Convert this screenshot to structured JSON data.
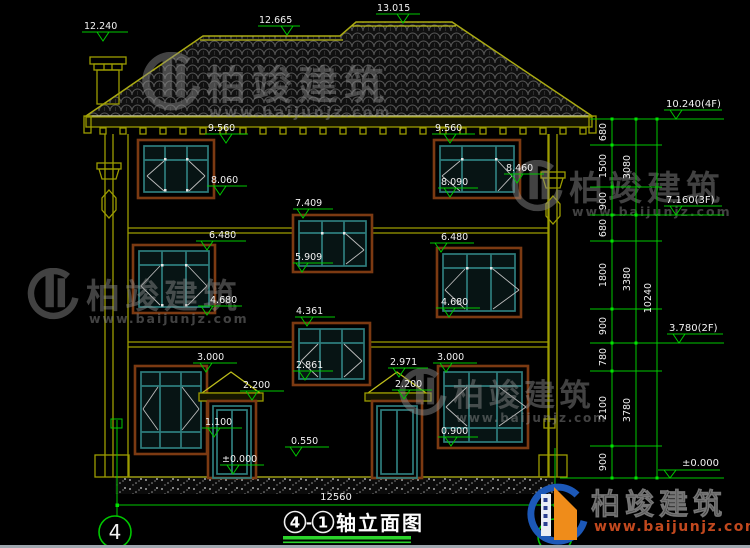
{
  "watermark": {
    "brand": "柏竣建筑",
    "url": "www.baijunjz.com"
  },
  "logo": {
    "brand": "柏竣建筑",
    "url": "www.baijunjz.com"
  },
  "title": {
    "full": "④-①轴立面图",
    "bubble_from": "4",
    "dash": "-",
    "bubble_to": "1",
    "name": "轴立面图",
    "grid_bubble_left": "4"
  },
  "dims": {
    "overall_width": "12560",
    "overall_height": "10240",
    "floor_totals": [
      "3080",
      "3380",
      "3780"
    ],
    "segments": [
      "680",
      "1500",
      "900",
      "680",
      "1800",
      "900",
      "780",
      "2100",
      "900"
    ]
  },
  "levels": {
    "chimney": "12.240",
    "ridge_low": "12.665",
    "ridge_high": "13.015",
    "eave_left": "9.560",
    "eave_right": "9.560",
    "w3_left_bottom": "8.060",
    "w3_right_bottom": "8.090",
    "pilaster_right_top": "8.460",
    "stair_win_top": "7.409",
    "stair_win_bottom": "5.909",
    "w2_left_top": "6.480",
    "w2_right_top": "6.480",
    "w2_left_bottom": "4.680",
    "w2_right_bottom": "4.680",
    "mid_win_top": "4.361",
    "mid_win_bottom": "2.861",
    "w1_left_top": "3.000",
    "w1_right_top": "3.000",
    "porch_right_apex": "2.971",
    "porch_left_slab": "2.200",
    "porch_right_slab": "2.200",
    "door_left_sill": "1.100",
    "plinth_center": "0.550",
    "w1_right_bottom": "0.900",
    "ground_left": "±0.000",
    "ground_right": "±0.000",
    "floor4": "10.240(4F)",
    "floor3": "7.160(3F)",
    "floor2": "3.780(2F)"
  }
}
